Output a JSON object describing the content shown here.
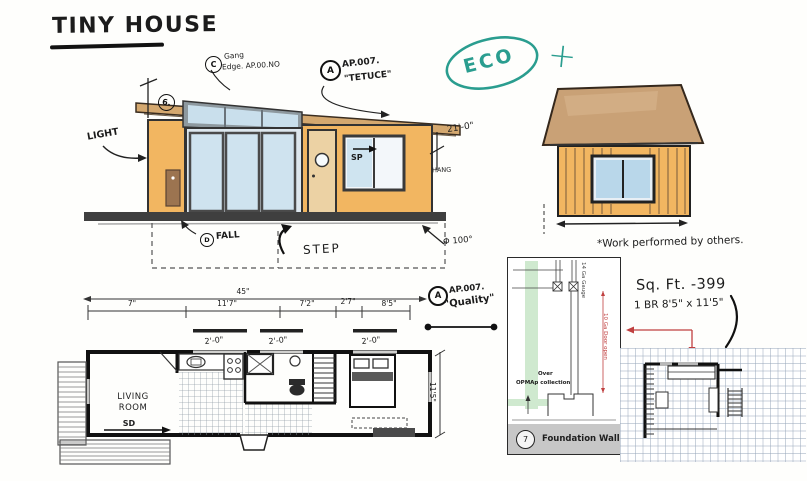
{
  "title": "TINY HOUSE",
  "logo": {
    "text": "ECO",
    "plus": "+"
  },
  "elevation": {
    "callout_c_badge": "C",
    "callout_c_line1": "Gang",
    "callout_c_line2": "Edge. AP.00.NO",
    "callout_a_badge": "A",
    "callout_a_line1": "AP.007.",
    "callout_a_line2": "\"TETUCE\"",
    "dim_badge": "6.",
    "light": "LIGHT",
    "sp": "SP",
    "hang": "HANG",
    "dim_right": "21'-0\"",
    "fall_badge": "D",
    "fall": "FALL",
    "step": "STEP",
    "angle": "Φ 100°",
    "quality_badge": "A",
    "quality_line1": "AP.007.",
    "quality_line2": "\"Quality\""
  },
  "side_house": {
    "note": "*Work performed by others."
  },
  "floor_plan": {
    "dim_overall": "45\"",
    "dims": [
      "7\"",
      "11'7\"",
      "7'2\"",
      "2'7\"",
      "8'5\""
    ],
    "window_dims": [
      "2'-0\"",
      "2'-0\"",
      "2'-0\""
    ],
    "dim_side": "11'5\"",
    "living_line1": "LIVING",
    "living_line2": "ROOM",
    "sd": "SD"
  },
  "foundation": {
    "number": "7",
    "label": "Foundation Wall",
    "note_gauge": "14 Ga Gauge",
    "note_door": "10 Ga Door open",
    "note_over": "Over",
    "note_collection": "OPMAp collection"
  },
  "notes": {
    "sqft": "Sq. Ft.  -399",
    "br": "1 BR 8'5\" x 11'5\""
  },
  "colors": {
    "teal": "#2a9d8f",
    "wall": "#f2b661",
    "roof": "#c9a176",
    "glass": "#bcd8ea",
    "red": "#c04040",
    "green": "#cfe9cf"
  }
}
